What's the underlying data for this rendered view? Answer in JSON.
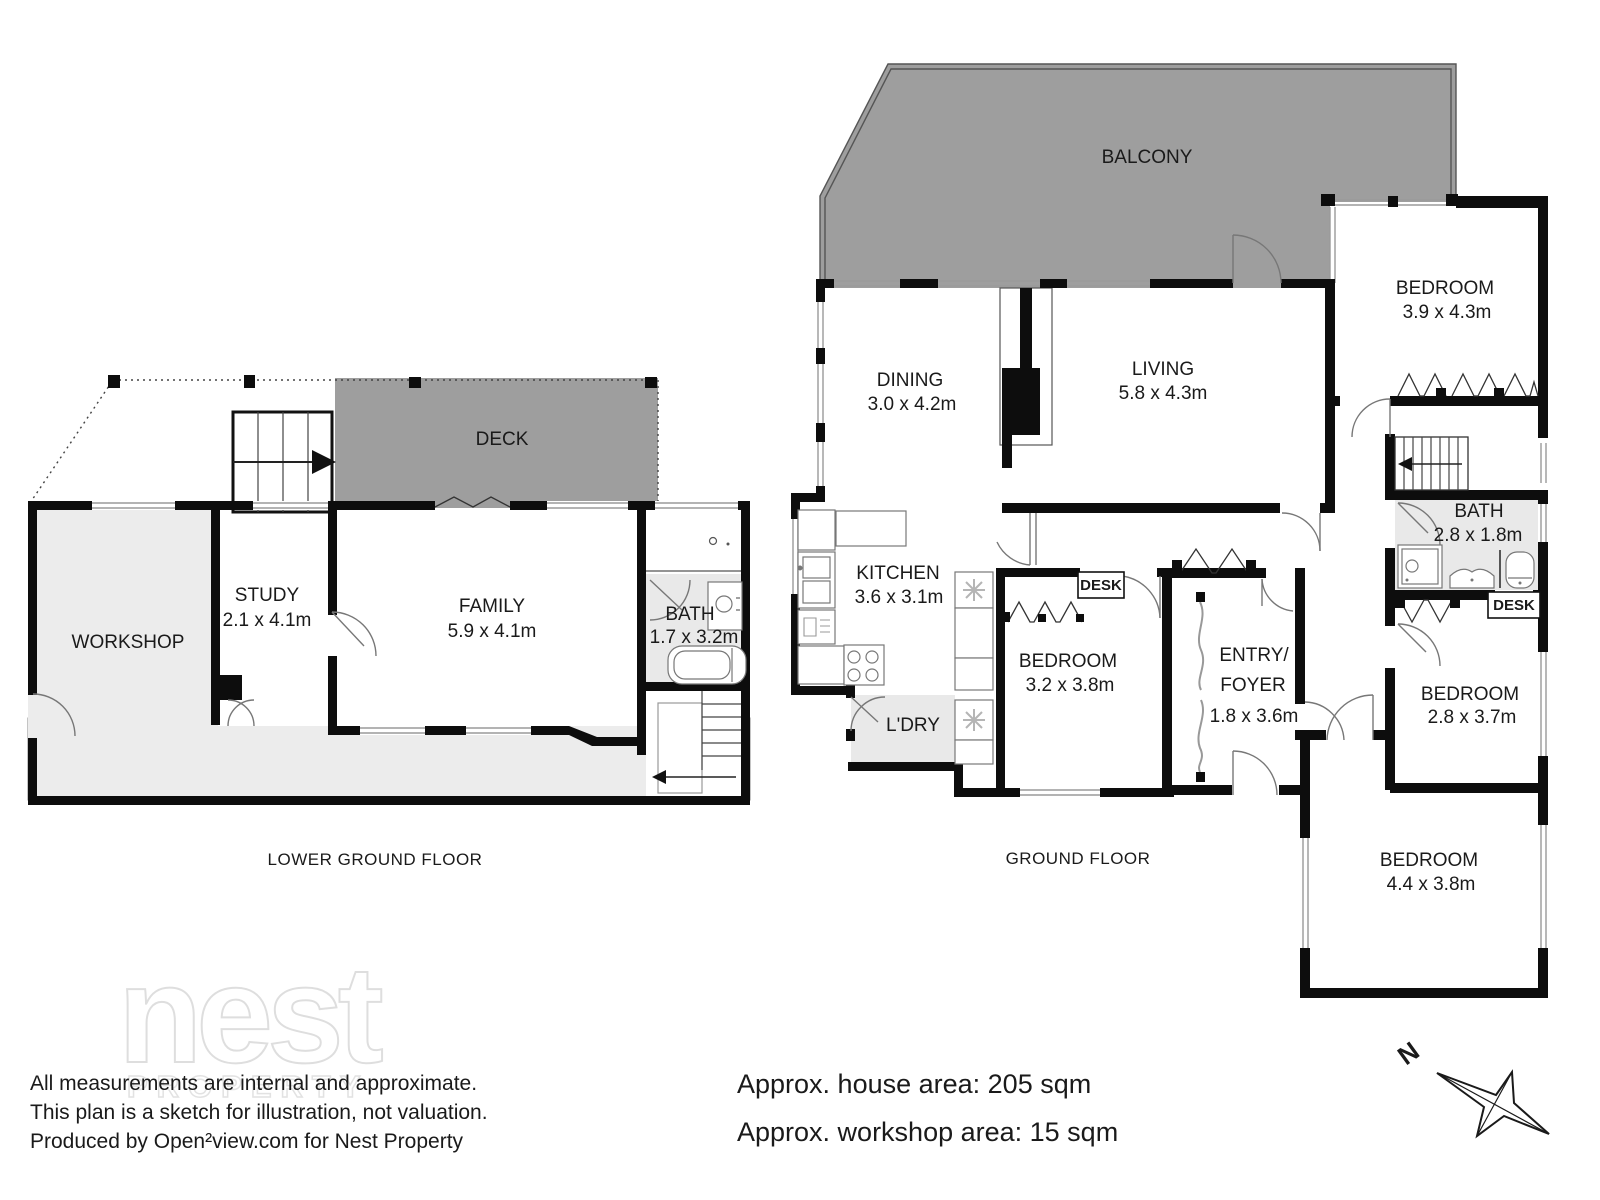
{
  "floors": {
    "lower": {
      "title": "LOWER GROUND FLOOR"
    },
    "ground": {
      "title": "GROUND FLOOR"
    }
  },
  "rooms": {
    "deck": {
      "name": "DECK"
    },
    "workshop": {
      "name": "WORKSHOP"
    },
    "study": {
      "name": "STUDY",
      "dims": "2.1 x 4.1m"
    },
    "family": {
      "name": "FAMILY",
      "dims": "5.9 x 4.1m"
    },
    "bath_lower": {
      "name": "BATH",
      "dims": "1.7 x 3.2m"
    },
    "balcony": {
      "name": "BALCONY"
    },
    "dining": {
      "name": "DINING",
      "dims": "3.0 x 4.2m"
    },
    "living": {
      "name": "LIVING",
      "dims": "5.8 x 4.3m"
    },
    "kitchen": {
      "name": "KITCHEN",
      "dims": "3.6 x 3.1m"
    },
    "laundry": {
      "name": "L'DRY"
    },
    "bedroom1": {
      "name": "BEDROOM",
      "dims": "3.9 x 4.3m"
    },
    "bedroom2": {
      "name": "BEDROOM",
      "dims": "3.2 x 3.8m"
    },
    "bedroom3": {
      "name": "BEDROOM",
      "dims": "2.8 x 3.7m"
    },
    "bedroom4": {
      "name": "BEDROOM",
      "dims": "4.4 x 3.8m"
    },
    "bath_ground": {
      "name": "BATH",
      "dims": "2.8 x 1.8m"
    },
    "entry": {
      "line1": "ENTRY/",
      "line2": "FOYER",
      "dims": "1.8 x 3.6m"
    },
    "desk1": {
      "name": "DESK"
    },
    "desk2": {
      "name": "DESK"
    }
  },
  "footer": {
    "disclaimer1": "All measurements are internal and approximate.",
    "disclaimer2": "This plan is a sketch for illustration, not valuation.",
    "disclaimer3": "Produced by Open²view.com for Nest Property",
    "house_area": "Approx. house area: 205 sqm",
    "workshop_area": "Approx. workshop area: 15 sqm"
  },
  "watermark": {
    "brand": "nest",
    "sub": "PROPERTY"
  },
  "compass": {
    "north": "N"
  },
  "colors": {
    "deck_gray": "#9e9e9e",
    "room_gray": "#e9e9e9",
    "slab_gray": "#ececec",
    "wall_black": "#0d0d0d"
  }
}
